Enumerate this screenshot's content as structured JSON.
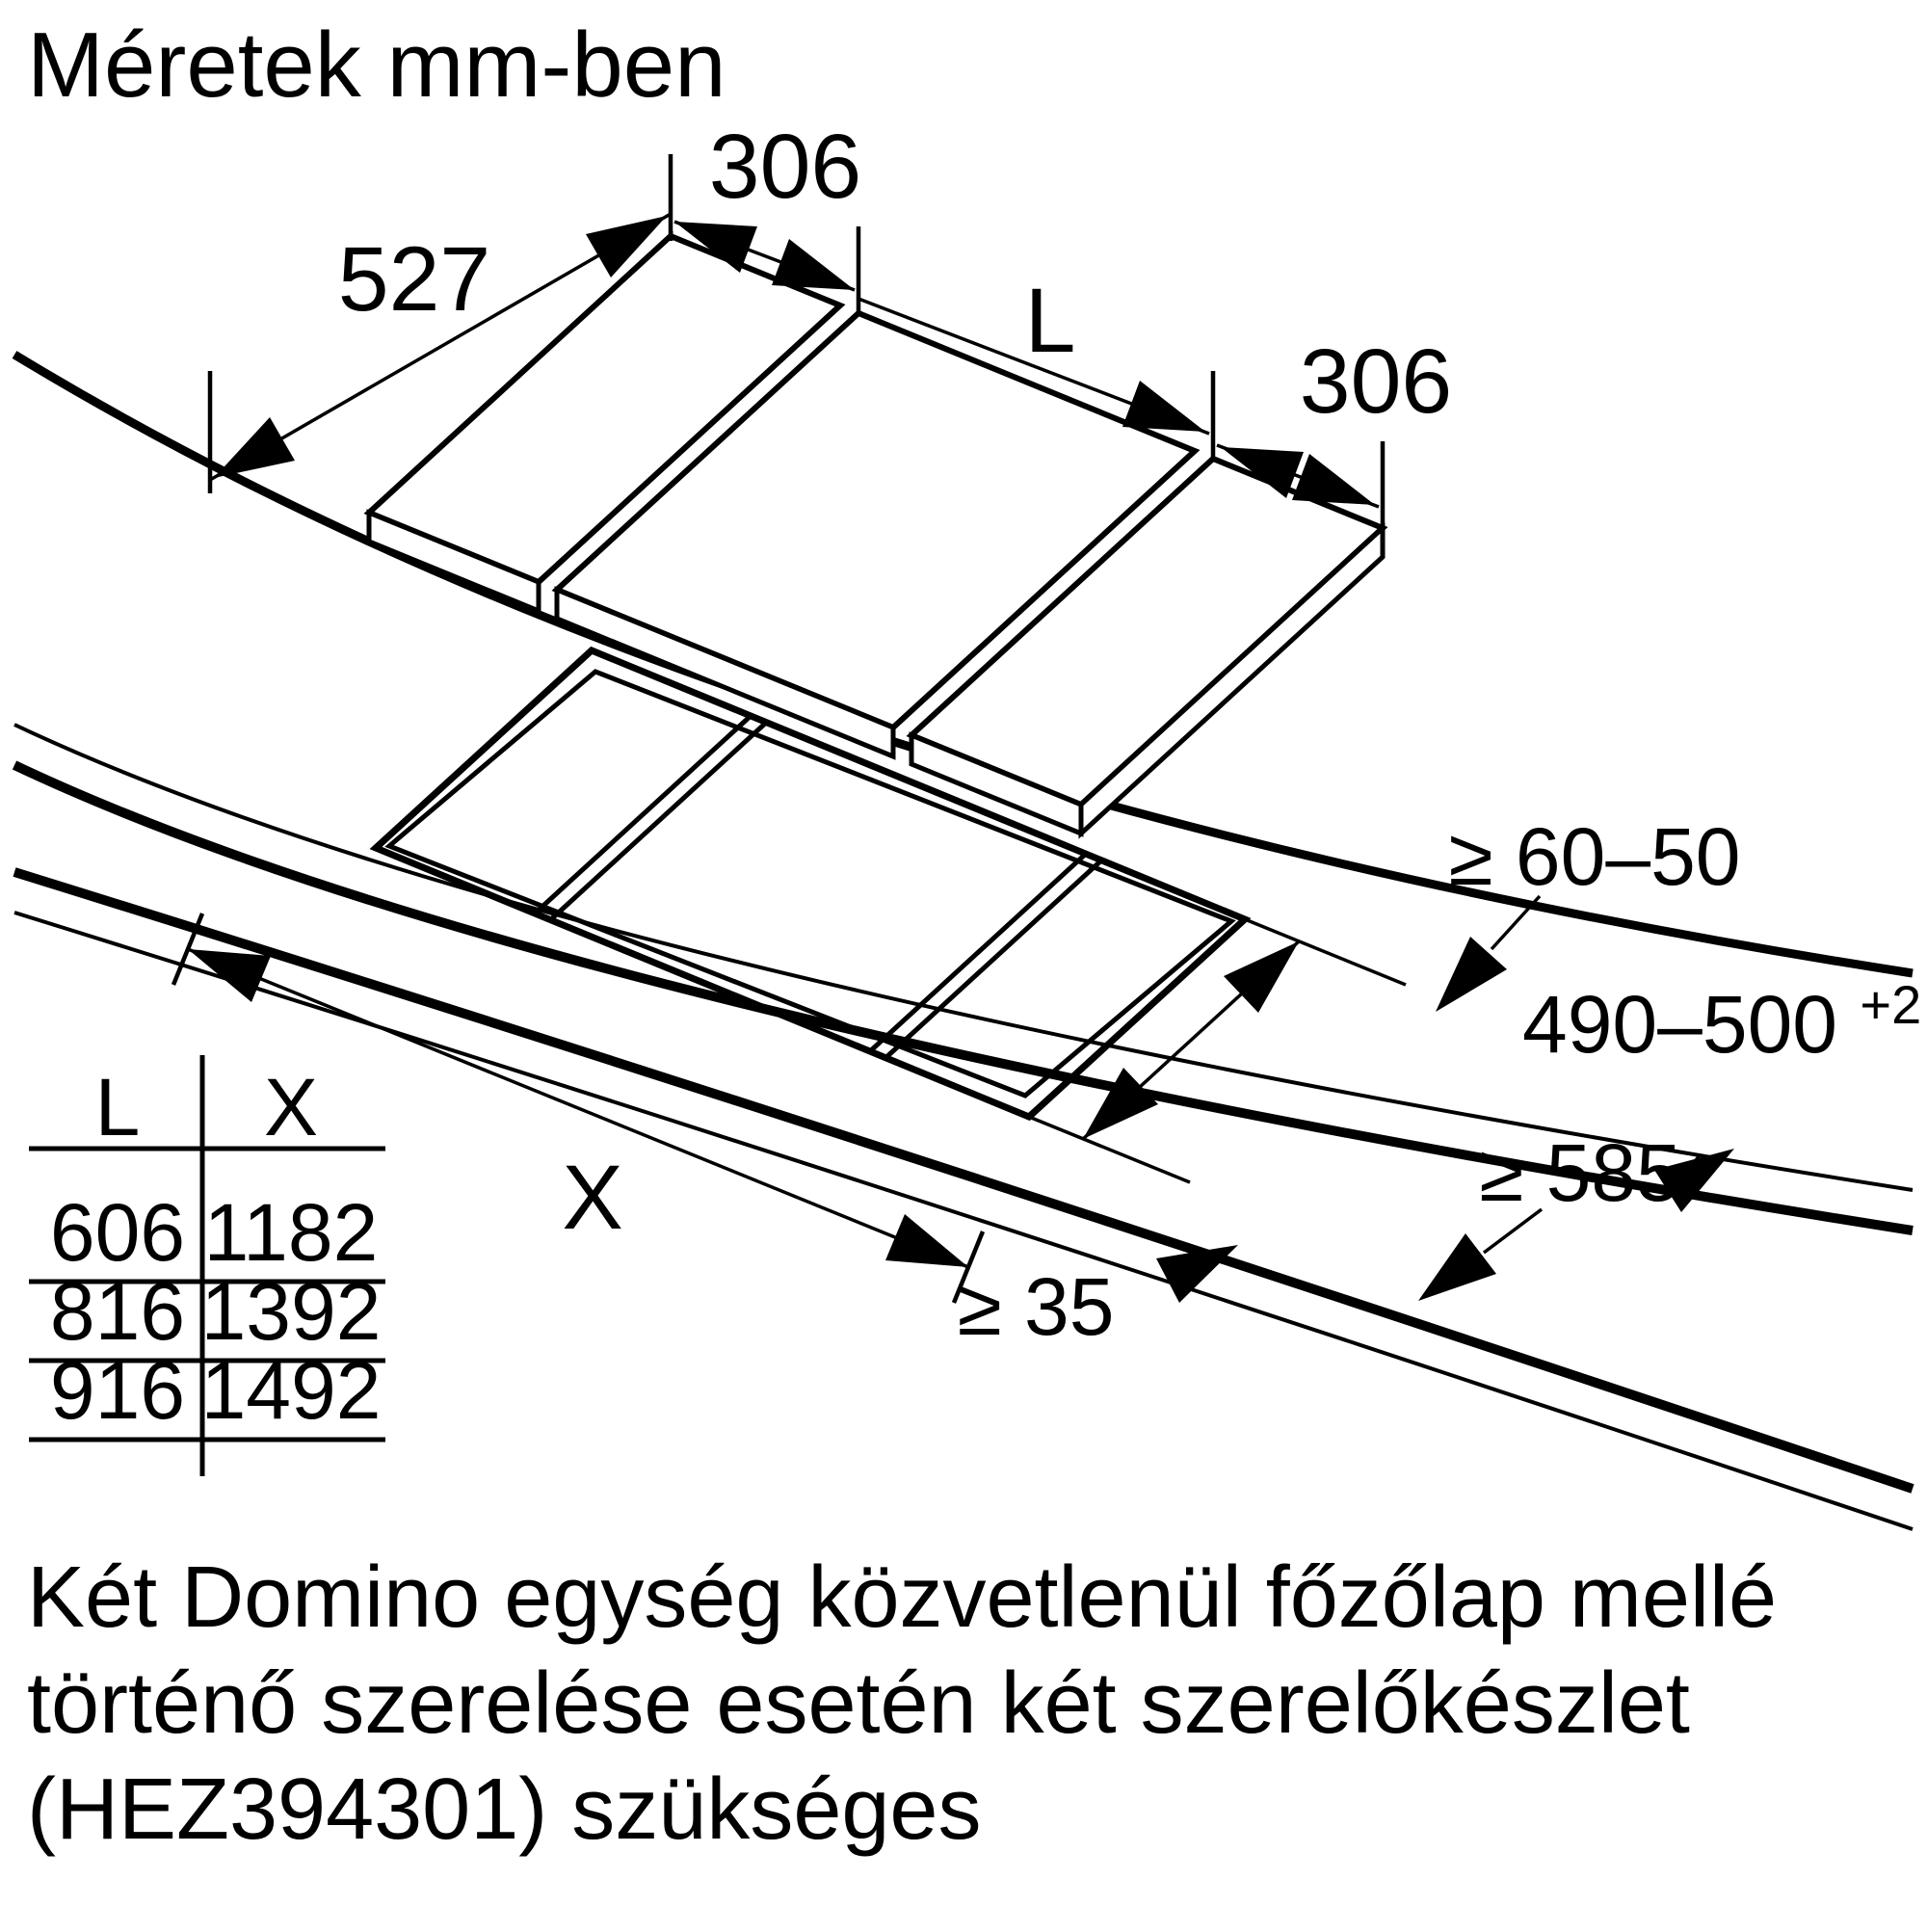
{
  "title": "Méretek mm-ben",
  "colors": {
    "ink": "#000000",
    "background": "#ffffff"
  },
  "dimensions": {
    "left_width": "306",
    "depth": "527",
    "hob_length": "L",
    "right_width": "306",
    "rear_clearance": "≥ 60–50",
    "cutout_depth": "490–500",
    "cutout_depth_tolerance": "+2",
    "worktop_depth": "≥ 585",
    "front_clearance": "≥ 35",
    "cutout_length": "X"
  },
  "table": {
    "headers": [
      "L",
      "X"
    ],
    "rows": [
      [
        "606",
        "1182"
      ],
      [
        "816",
        "1392"
      ],
      [
        "916",
        "1492"
      ]
    ]
  },
  "note": {
    "line1": "Két Domino egység közvetlenül főzőlap mellé",
    "line2": "történő szerelése esetén két szerelőkészlet",
    "line3": "(HEZ394301) szükséges"
  }
}
